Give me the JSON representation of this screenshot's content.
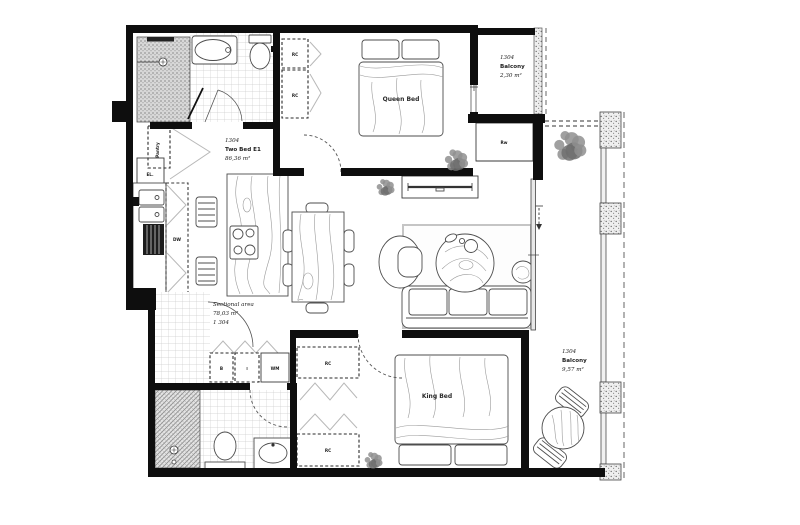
{
  "unit_label": {
    "number": "1304",
    "type": "Two Bed E1",
    "area": "86,36 m²"
  },
  "sectional_label": {
    "title": "Sectional area",
    "area": "78,03 m²",
    "number": "1 304"
  },
  "balcony_top": {
    "number": "1304",
    "name": "Balcony",
    "area": "2,30 m²"
  },
  "balcony_right": {
    "number": "1304",
    "name": "Balcony",
    "area": "9,57 m²"
  },
  "bedroom_queen": {
    "bed": "Queen Bed",
    "closet_upper": "RC",
    "closet_lower": "RC"
  },
  "bedroom_king": {
    "bed": "King Bed",
    "closet_upper": "RC",
    "closet_lower": "RC"
  },
  "closet_room": {
    "label": "Rw"
  },
  "kitchen": {
    "dishwasher": "DW",
    "electrical_panel": "EL.",
    "pantry": "Pantry"
  },
  "laundry": {
    "unit1": "B",
    "unit2": "⁝",
    "washing_machine": "WM"
  },
  "colors": {
    "wall": "#0e0e0e",
    "plant": "#8f8f8f",
    "tile_line": "#cdcdcd"
  }
}
